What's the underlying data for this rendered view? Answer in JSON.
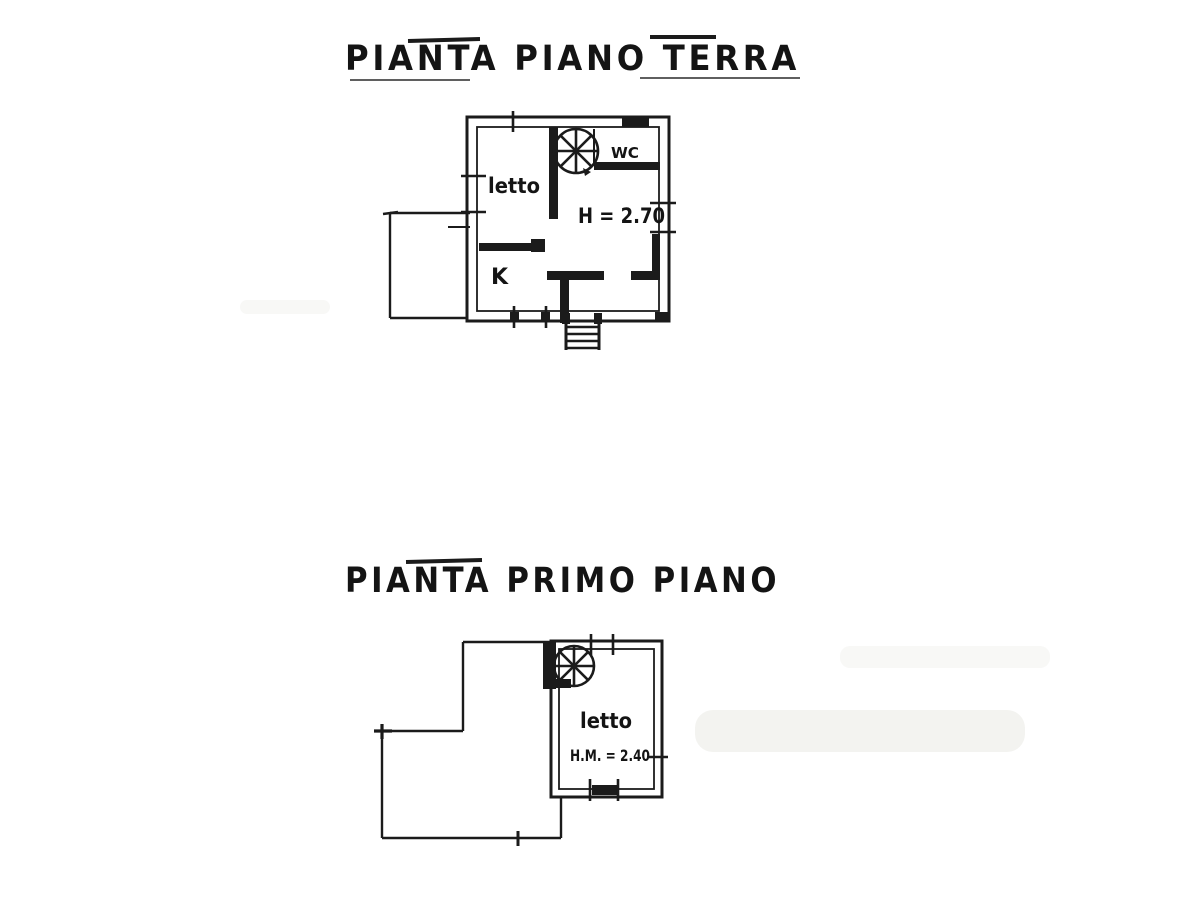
{
  "colors": {
    "ink": "#1b1b1b",
    "paper": "#ffffff",
    "smudge": "#f1f1ee"
  },
  "ground_floor": {
    "title": "PIANTA PIANO TERRA",
    "room_labels": {
      "bedroom": "letto",
      "wc": "WC",
      "kitchen": "K",
      "ceiling_height": "H = 2.70"
    }
  },
  "first_floor": {
    "title": "PIANTA PRIMO PIANO",
    "room_labels": {
      "bedroom": "letto",
      "ceiling_height": "H.M. = 2.40"
    }
  }
}
